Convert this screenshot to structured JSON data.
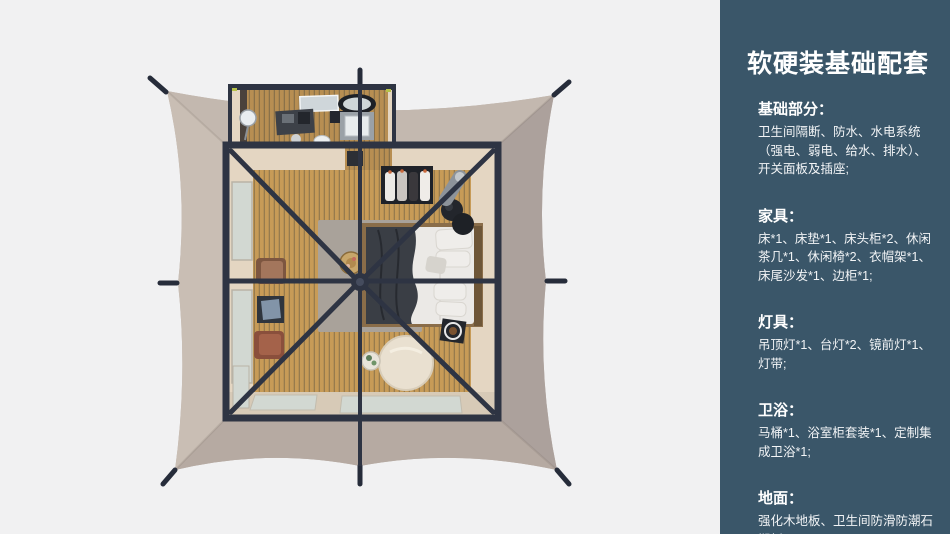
{
  "colors": {
    "background": "#f1f1f2",
    "sidebar_bg": "#3a5669",
    "sidebar_text": "#ffffff",
    "canvas_base": "#bcb1a9",
    "canvas_top": "#c3b8af",
    "canvas_left": "#c9beb4",
    "canvas_right": "#aca19c",
    "canvas_bottom": "#b6aaa2",
    "frame_dark": "#2e3443",
    "wood_floor": "#c79b57",
    "wood_seam": "#6e6045",
    "wall_cream": "#e4d6c2",
    "porch_cream": "#d7cab7",
    "glass": "#d2d8d2",
    "rug": "#a9a29a",
    "bed_white": "#ebe9e6",
    "throw_dark": "#3a3e45",
    "chair_brown": "#a3765c",
    "pouf_cream": "#e9e0d0"
  },
  "sidebar": {
    "title": "软硬装基础配套",
    "sections": [
      {
        "heading": "基础部分：",
        "body": "卫生间隔断、防水、水电系统（强电、弱电、给水、排水）、开关面板及插座;"
      },
      {
        "heading": "家具：",
        "body": "床*1、床垫*1、床头柜*2、休闲茶几*1、休闲椅*2、衣帽架*1、床尾沙发*1、边柜*1;"
      },
      {
        "heading": "灯具：",
        "body": "吊顶灯*1、台灯*2、镜前灯*1、灯带;"
      },
      {
        "heading": "卫浴：",
        "body": "马桶*1、浴室柜套装*1、定制集成卫浴*1;"
      },
      {
        "heading": "地面：",
        "body": "强化木地板、卫生间防滑防潮石塑板;"
      }
    ]
  }
}
